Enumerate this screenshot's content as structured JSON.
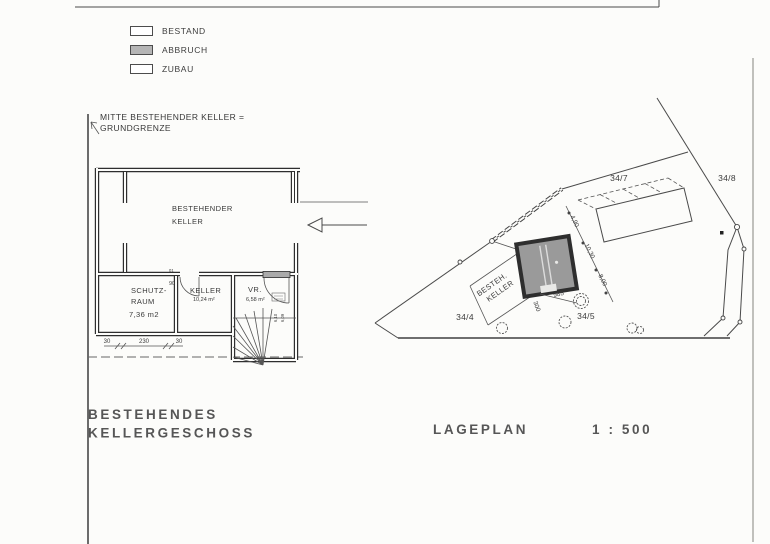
{
  "legend": {
    "items": [
      {
        "label": "BESTAND",
        "fill": "#ffffff"
      },
      {
        "label": "ABBRUCH",
        "fill": "#b5b5b5"
      },
      {
        "label": "ZUBAU",
        "fill": "#ffffff"
      }
    ]
  },
  "boundary_note": {
    "line1": "MITTE BESTEHENDER KELLER =",
    "line2": "GRUNDGRENZE"
  },
  "floor_plan": {
    "main_room": {
      "line1": "BESTEHENDER",
      "line2": "KELLER"
    },
    "schutzraum": {
      "line1": "SCHUTZ-",
      "line2": "RAUM",
      "area": "7,36 m2"
    },
    "keller": {
      "name": "KELLER",
      "area": "10,24 m²"
    },
    "vorraum": {
      "name": "VR.",
      "area": "6,58 m²"
    },
    "door": {
      "tag": "01",
      "width": "90"
    },
    "stair": {
      "note1": "6,10",
      "note2": "6,09"
    },
    "dims": {
      "left": "30",
      "middle": "230",
      "right": "30"
    }
  },
  "titles": {
    "floor_line1": "BESTEHENDES",
    "floor_line2": "KELLERGESCHOSS",
    "site": "LAGEPLAN",
    "scale": "1 : 500"
  },
  "site_plan": {
    "parcels": {
      "p34_7": "34/7",
      "p34_8": "34/8",
      "p34_4": "34/4",
      "p34_5": "34/5"
    },
    "building": {
      "line1": "BESTEH.",
      "line2": "KELLER"
    },
    "dims": {
      "d1": "4,90",
      "d2": "10,30",
      "d3": "8,00",
      "d4": "985",
      "d5": "300"
    }
  },
  "colors": {
    "abbruch_fill": "#b5b5b5",
    "bestand_fill": "#ffffff",
    "line": "#3c3c3c"
  }
}
